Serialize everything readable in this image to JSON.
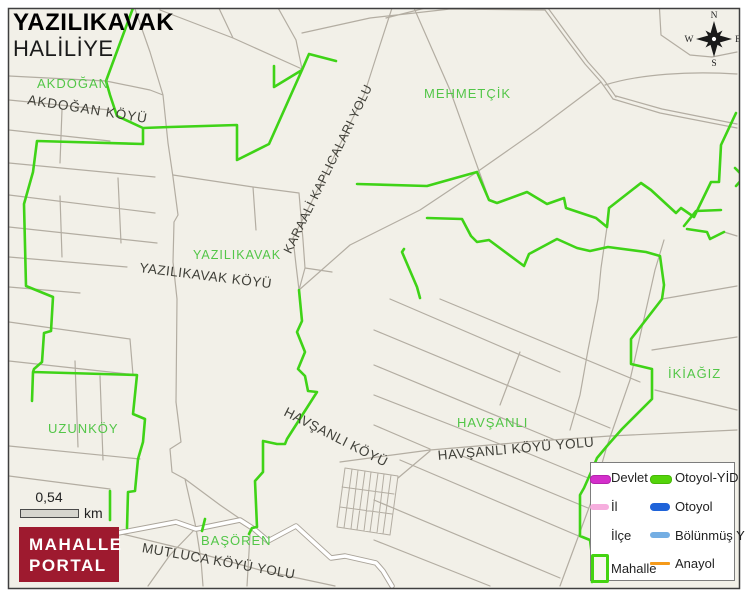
{
  "map": {
    "title": "YAZILIKAVAK",
    "subtitle": "HALİLİYE",
    "area_labels": [
      {
        "text": "AKDOĞAN"
      },
      {
        "text": "MEHMETÇİK"
      },
      {
        "text": "YAZILIKAVAK"
      },
      {
        "text": "UZUNKÖY"
      },
      {
        "text": "HAVŞANLI"
      },
      {
        "text": "İKİAĞIZ"
      },
      {
        "text": "BAŞÖREN"
      }
    ],
    "road_labels": [
      {
        "text": "AKDOĞAN KÖYÜ"
      },
      {
        "text": "KARAALİ KAPLICALARI YOLU"
      },
      {
        "text": "YAZILIKAVAK KÖYÜ"
      },
      {
        "text": "HAVŞANLI KÖYÜ"
      },
      {
        "text": "HAVŞANLI KÖYÜ YOLU"
      },
      {
        "text": "MUTLUCA KÖYÜ YOLU"
      }
    ]
  },
  "compass": {
    "north": "N",
    "east": "E",
    "south": "S",
    "west": "W"
  },
  "scale_bar": {
    "value": "0,54",
    "unit": "km"
  },
  "logo": {
    "line1": "MAHALLE",
    "line2": "PORTAL"
  },
  "legend": {
    "column1": [
      {
        "label": "Devlet",
        "color": "#d42ecb"
      },
      {
        "label": "İl",
        "color": "#f6aede"
      },
      {
        "label": "İlçe",
        "color": "#ffffff"
      },
      {
        "label": "Mahalle",
        "color": "#44d411"
      }
    ],
    "column2": [
      {
        "label": "Otoyol-YİD",
        "color": "#54d40a"
      },
      {
        "label": "Otoyol",
        "color": "#1f63d9"
      },
      {
        "label": "Bölünmüş Y",
        "color": "#74aee3"
      },
      {
        "label": "Anayol",
        "color": "#f59a19"
      }
    ]
  },
  "colors": {
    "map_background": "#f2f0e8",
    "boundary_green": "#3fd317",
    "road_gray": "#b3ada2",
    "major_road_white": "#ffffff",
    "area_label_green": "#53c648",
    "road_label_dark": "#3f3f38",
    "logo_red": "#9e1a2f",
    "border_dark": "#3f3f3f"
  }
}
